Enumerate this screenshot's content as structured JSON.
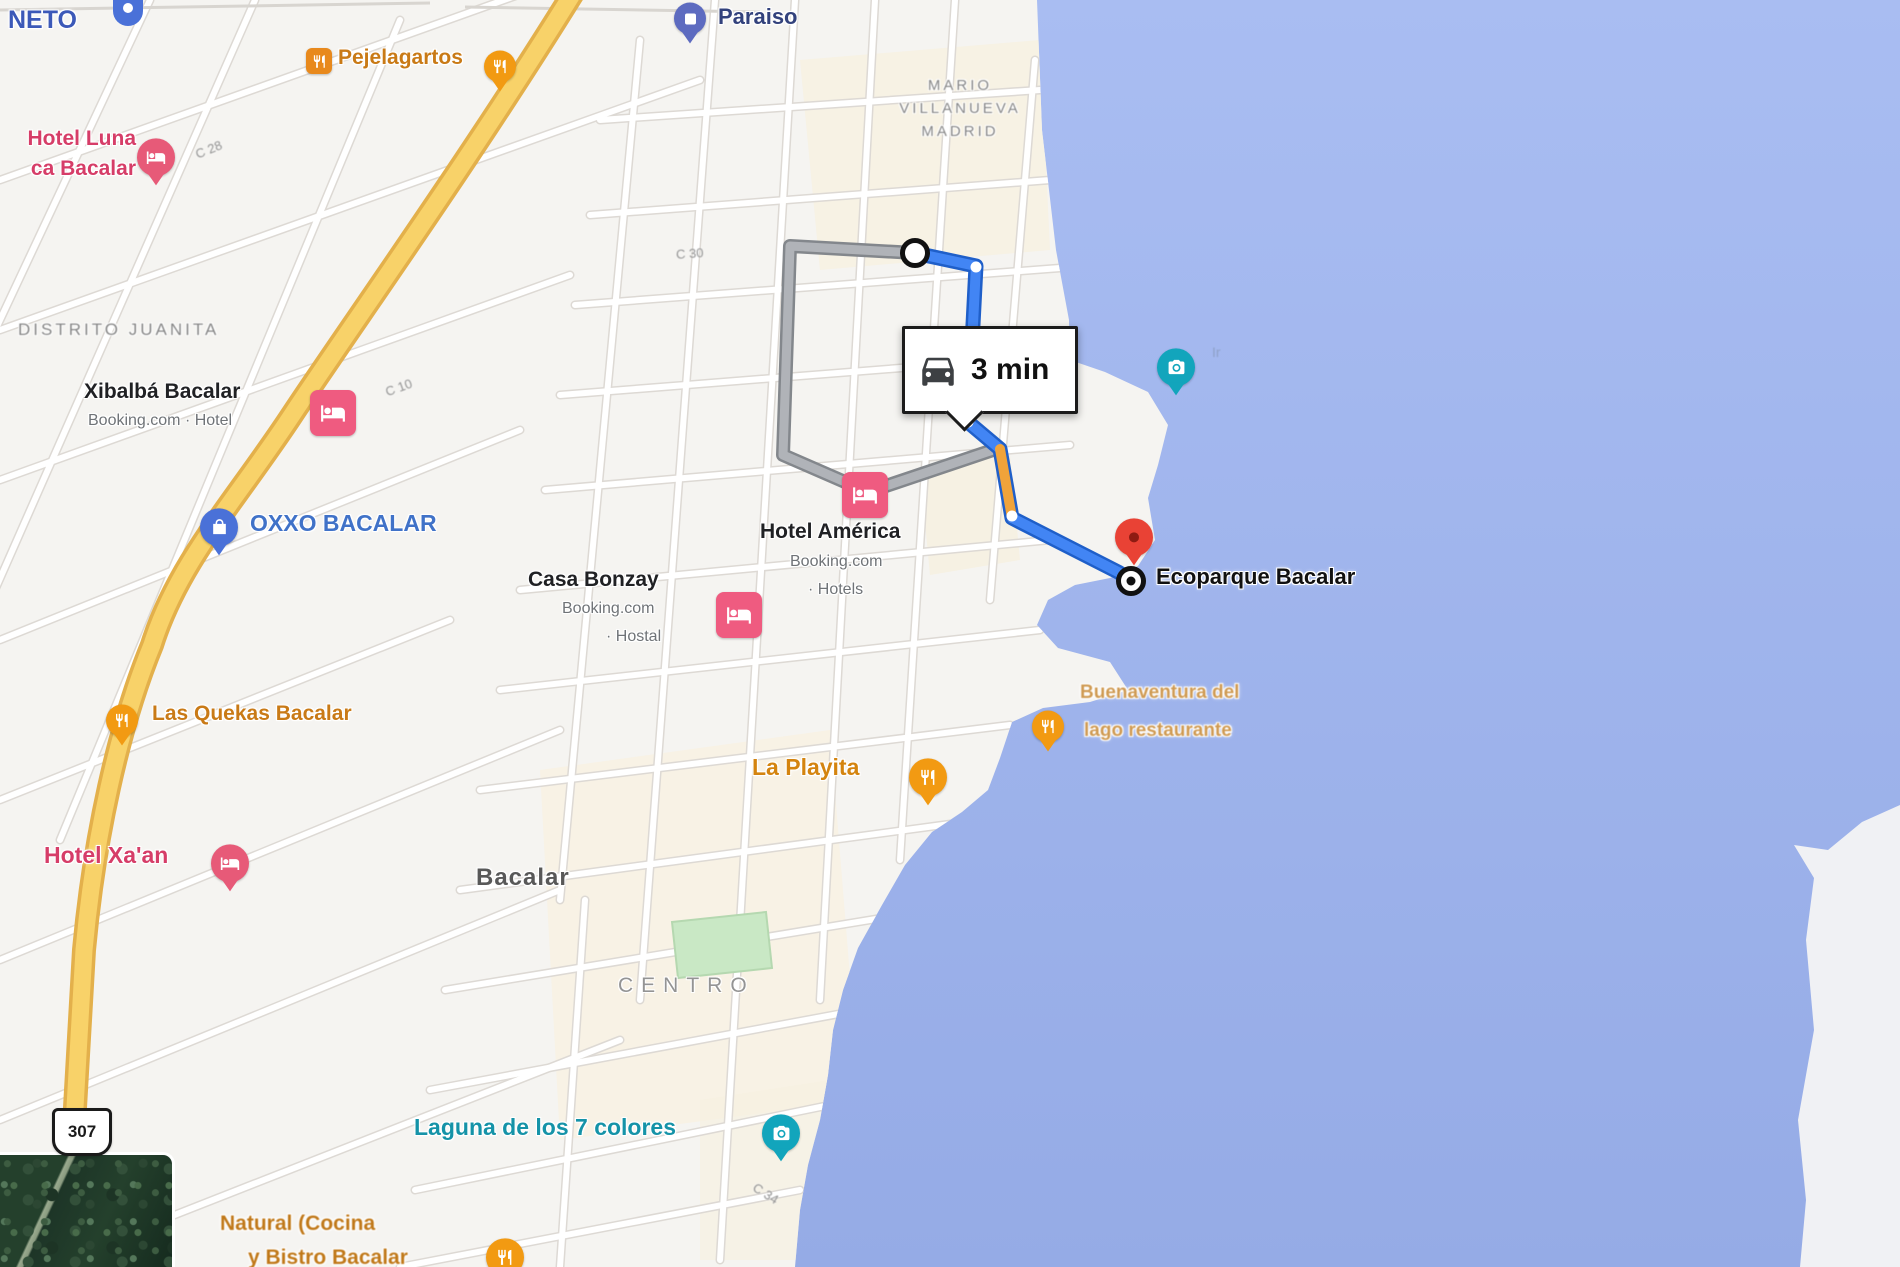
{
  "route": {
    "duration": "3 min",
    "mode": "driving",
    "destination_label": "Ecoparque Bacalar"
  },
  "labels": {
    "neto": "NETO",
    "paraiso": "Paraiso",
    "pejelagartos": "Pejelagartos",
    "hotel_luna_line1": "Hotel Luna",
    "hotel_luna_line2": "ca Bacalar",
    "distrito": "DISTRITO JUANITA",
    "xibalba": "Xibalbá Bacalar",
    "xibalba_sub": "Booking.com · Hotel",
    "oxxo": "OXXO BACALAR",
    "casa_bonzay": "Casa Bonzay",
    "casa_bonzay_sub1": "Booking.com",
    "casa_bonzay_sub2": "· Hostal",
    "hotel_america": "Hotel América",
    "hotel_america_sub1": "Booking.com",
    "hotel_america_sub2": "· Hotels",
    "mario_line1": "MARIO",
    "mario_line2": "VILLANUEVA",
    "mario_line3": "MADRID",
    "quekas": "Las Quekas Bacalar",
    "hotel_xaan": "Hotel Xa'an",
    "la_playita": "La Playita",
    "buenaventura_line1": "Buenaventura del",
    "buenaventura_line2": "lago restaurante",
    "bacalar": "Bacalar",
    "centro": "CENTRO",
    "laguna": "Laguna de los 7 colores",
    "natural_line1": "Natural (Cocina",
    "natural_line2": "y Bistro Bacalar",
    "shield": "307",
    "water_mark": "Ir"
  },
  "street_fragments": [
    "C 28",
    "C 10",
    "C 30",
    "C 34"
  ],
  "colors": {
    "water": "#9fb5ed",
    "land": "#f5f4f1",
    "highway_yellow": "#f8d269",
    "route_blue": "#4285f4",
    "route_alt_gray": "#b0b3b8",
    "traffic_orange": "#f0a33a",
    "pin_restaurant_orange": "#f29a12",
    "pin_lodging_pink": "#e75a78",
    "pin_attraction_teal": "#12a5bc",
    "pin_shopping_blue": "#4a71d8",
    "destination_red": "#e94235",
    "park_green": "#c9e8c5"
  }
}
